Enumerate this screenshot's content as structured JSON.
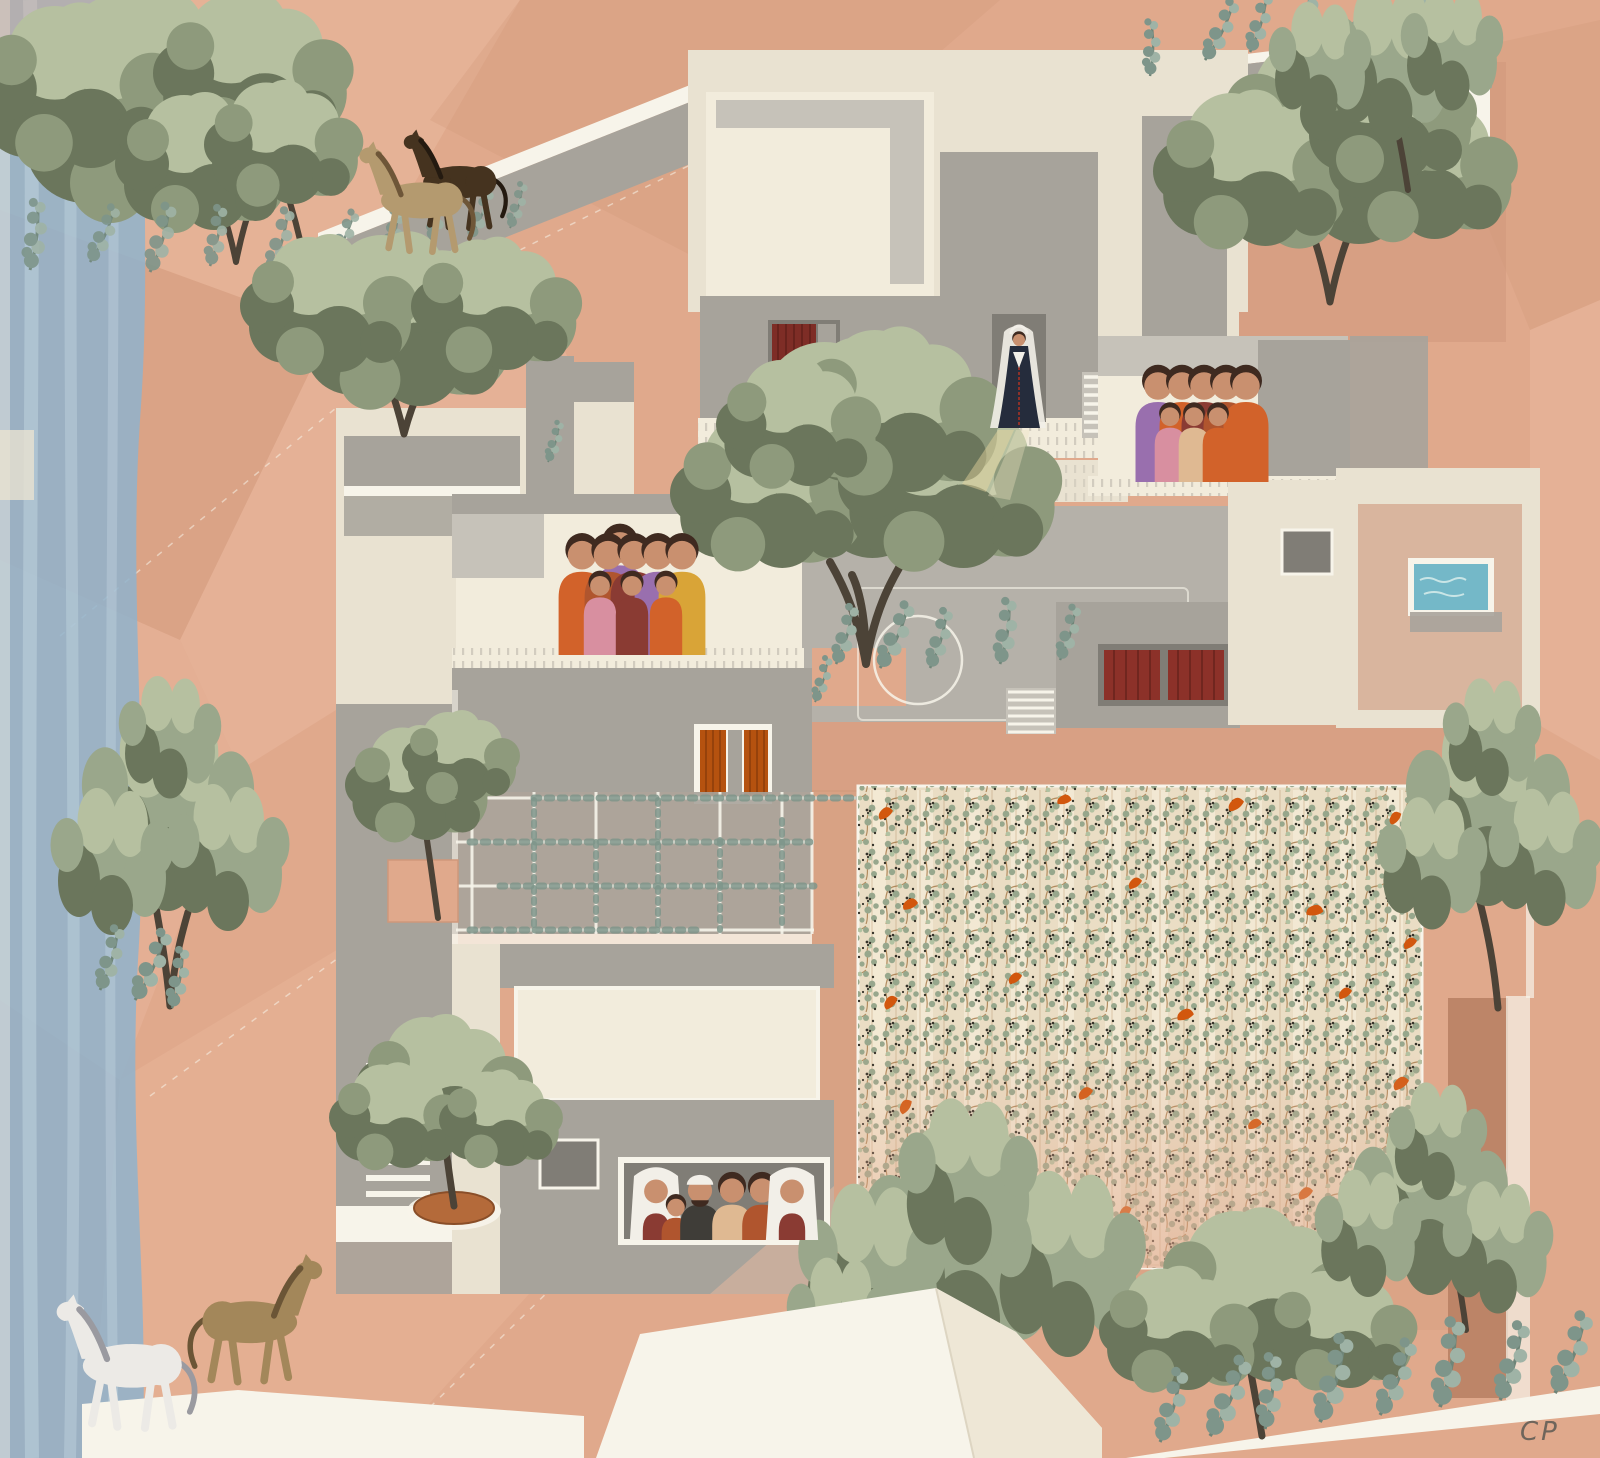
{
  "artwork": {
    "type": "architectural collage illustration",
    "view": "axonometric site drawing",
    "setting": "Mediterranean terraced housing cluster with courtyards, olive trees, vineyard, horses and family figures",
    "signature_text": "CP"
  },
  "palette": {
    "background": "#e0a98c",
    "facet_light": "#eab99f",
    "facet_dark": "#cf987b",
    "facet_deep": "#b27a5c",
    "paper_white": "#f7f4ea",
    "cream": "#e9e2d1",
    "cream_bright": "#f2ecdc",
    "grey_light": "#c6c2b9",
    "grey_mid": "#a7a39b",
    "grey_dark": "#8b8780",
    "grey_court": "#b5b1a9",
    "window_grey": "#807d76",
    "shutter_red": "#7e2d26",
    "shutter_orange": "#b5520f",
    "door_red": "#8c3129",
    "pool_blue": "#74b8c8",
    "water_blue": "#8fb3cc",
    "water_blue_light": "#c2d5e0",
    "olive_green": "#8e9a7c",
    "olive_light": "#b6c0a0",
    "olive_dark": "#6b765c",
    "pine_green": "#9aa78b",
    "eucalyptus_green": "#7e958a",
    "vineyard_base": "#eaddc4",
    "vineyard_leaf": "#93a489",
    "vineyard_dark": "#2c2a22",
    "vineyard_orange": "#d2570e",
    "vine_brown": "#a0703d",
    "terracotta_pot": "#b46a3a",
    "horse_dark_brown": "#45331f",
    "horse_tan": "#b49a6f",
    "horse_buff": "#a3875a",
    "horse_white": "#eceae6",
    "skin": "#c9906f",
    "hair_dark": "#3f2a20",
    "dress_orange": "#d2622a",
    "dress_rust": "#b0552e",
    "dress_purple": "#996fae",
    "dress_maroon": "#8a3b33",
    "dress_yellow": "#d9a437",
    "dress_pink": "#d88fa0",
    "dress_peach": "#dfb992",
    "jacket_dark": "#3f3d38",
    "bride_dress": "#252c3c",
    "veil_white": "#f2efe8",
    "signature_ink": "#6f655b"
  },
  "scene": {
    "water_strip": {
      "location": "left edge",
      "description": "blue watercolor stream band"
    },
    "horses": [
      {
        "name": "dark-brown-horse",
        "location": "upper rooftop slab",
        "color_key": "horse_dark_brown"
      },
      {
        "name": "tan-horse",
        "location": "upper rooftop slab",
        "color_key": "horse_tan"
      },
      {
        "name": "buff-horse",
        "location": "lower-left ground",
        "color_key": "horse_buff"
      },
      {
        "name": "white-horse",
        "location": "lower-left ground",
        "color_key": "horse_white"
      }
    ],
    "figure_groups": [
      {
        "name": "bride",
        "count": 1,
        "location": "upper doorway",
        "dress": "dark embroidered gown, white veil, light spilling down the terrace"
      },
      {
        "name": "balcony-family",
        "count": 9,
        "location": "left balcony"
      },
      {
        "name": "terrace-family",
        "count": 8,
        "location": "upper-right terrace"
      },
      {
        "name": "window-family",
        "count": 6,
        "location": "lower window opening"
      }
    ],
    "vegetation": {
      "olive_trees": 6,
      "pine_trees": 5,
      "potted_trees": 2,
      "eucalyptus_clusters": 14,
      "pergola_vines": true
    },
    "architecture_features": [
      "rooftop slab bridges with eucalyptus planters",
      "blank cream facade panels",
      "bride doorway",
      "red curtain window",
      "orange shuttered window",
      "red double door",
      "vine-covered pergola grid",
      "courtyard with basketball-court marking",
      "small rooftop pool",
      "three stair flights",
      "tiled terrace tick-bands",
      "white folded rooftops",
      "planter ledge with eucalyptus"
    ],
    "vineyard": {
      "location": "lower right",
      "rows": 12,
      "description": "trellised vines with dark grape clusters and orange blossoms"
    }
  }
}
